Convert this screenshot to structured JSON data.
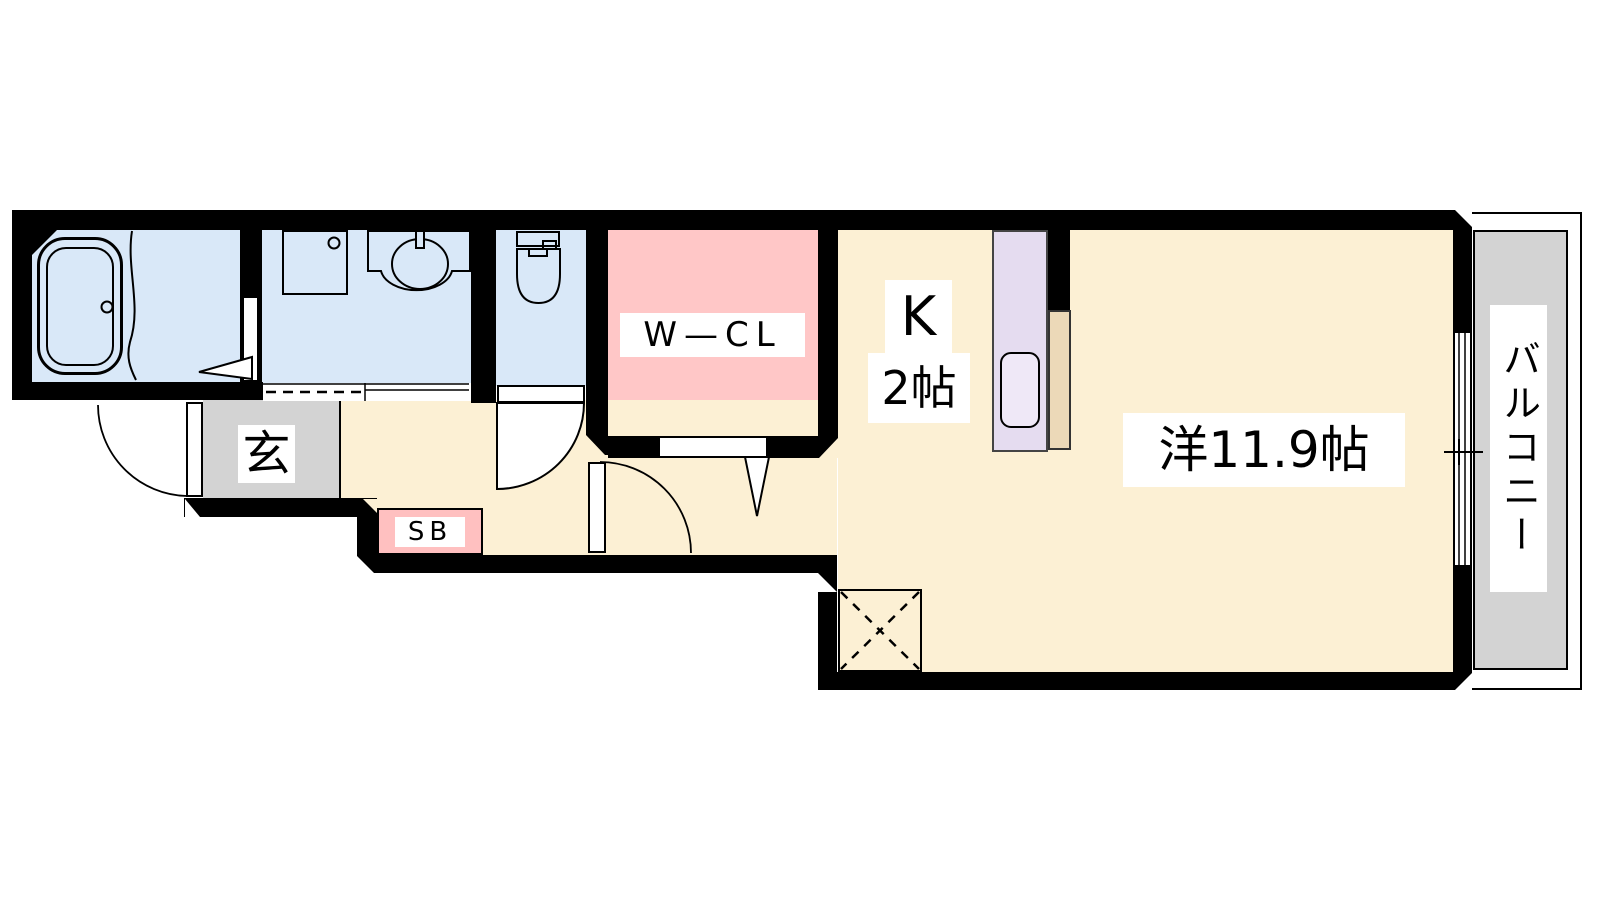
{
  "plan_type": "apartment-floor-plan",
  "labels": {
    "wcl": "W—CL",
    "kitchen_k": "K",
    "kitchen_size": "2帖",
    "living": "洋11.9帖",
    "entrance": "玄",
    "shoe_box": "SB",
    "balcony": "バルコニー"
  },
  "colors": {
    "wall": "#000000",
    "wet_area_floor": "#d9e8f8",
    "room_floor": "#fcf0d4",
    "closet_floor": "#ffc7c7",
    "entrance_floor": "#d3d3d3",
    "balcony_floor": "#d3d3d3",
    "kitchen_unit": "#e5dcf0",
    "kitchen_sink": "#efe8f7",
    "kitchen_counter_end": "#ecd9b8",
    "shoe_box_fill": "#ffc0c0",
    "label_background": "#ffffff"
  }
}
